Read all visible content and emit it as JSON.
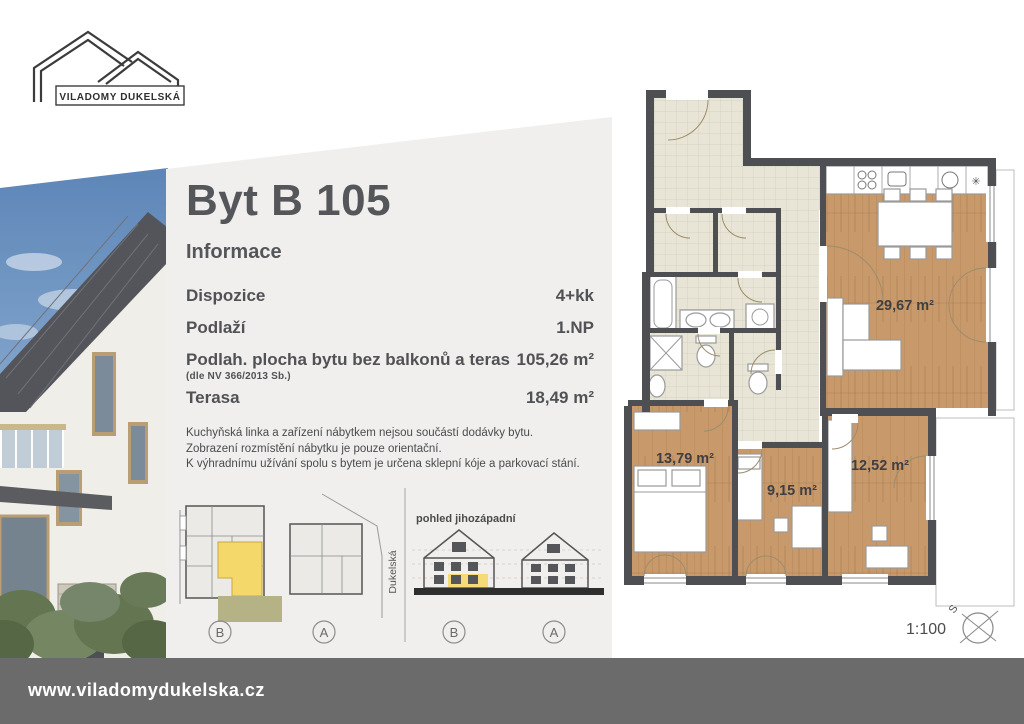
{
  "logo": {
    "text": "VILADOMY DUKELSKÁ"
  },
  "panel": {
    "title": "Byt B 105",
    "subtitle": "Informace",
    "rows": [
      {
        "label": "Dispozice",
        "value": "4+kk"
      },
      {
        "label": "Podlaží",
        "value": "1.NP"
      },
      {
        "label": "Podlah. plocha bytu bez balkonů a teras",
        "note": "(dle NV 366/2013 Sb.)",
        "value": "105,26 m²"
      },
      {
        "label": "Terasa",
        "value": "18,49 m²"
      }
    ],
    "disclaimer": [
      "Kuchyňská linka a zařízení nábytkem nejsou součástí dodávky bytu.",
      "Zobrazení rozmístění nábytku je pouze orientační.",
      "K výhradnímu užívání spolu s bytem je určena sklepní kóje a parkovací stání."
    ],
    "site_plan": {
      "labels": [
        "B",
        "A"
      ],
      "street": "Dukelská"
    },
    "elevation": {
      "caption": "pohled jihozápadní",
      "labels": [
        "B",
        "A"
      ]
    }
  },
  "floor_plan": {
    "rooms": [
      {
        "name": "living-room-kitchen",
        "area": "29,67 m²"
      },
      {
        "name": "bedroom-1",
        "area": "13,79 m²"
      },
      {
        "name": "bedroom-2",
        "area": "9,15 m²"
      },
      {
        "name": "bedroom-3",
        "area": "12,52 m²"
      }
    ],
    "scale": "1:100",
    "compass_label": "S",
    "kitchen_symbol": "✳"
  },
  "footer": {
    "url": "www.viladomydukelska.cz"
  },
  "colors": {
    "panel_bg": "#f0efed",
    "footer_bg": "#6b6b6b",
    "wall": "#4d4f52",
    "wood_floor": "#c89a6b",
    "tile_floor": "#e8e5d6",
    "highlight_yellow": "#f5d86a",
    "terrace_olive": "#b5b286",
    "sky_blue": "#5a83b5"
  }
}
